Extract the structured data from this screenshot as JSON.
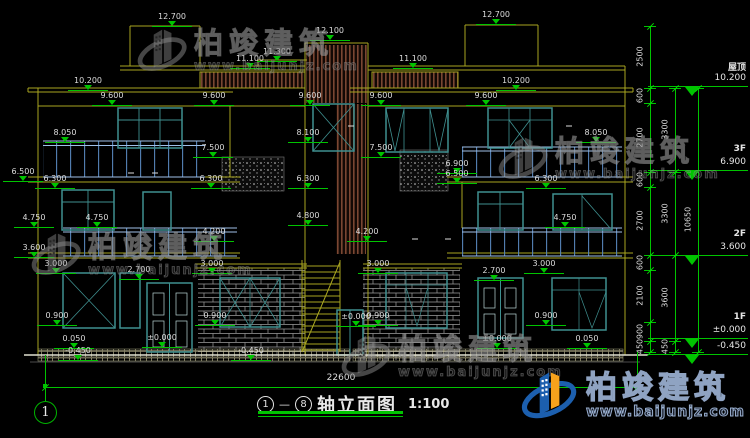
{
  "colors": {
    "yellow": "#a8a520",
    "teal": "#3f9090",
    "blue": "#5583b8",
    "green": "#00c400",
    "white": "#dcdcdc",
    "louver": "#7a4632",
    "wm_gray": "#8a8a8a",
    "logo_blue": "#1c5fae",
    "logo_orange": "#f6a21c"
  },
  "title_bar": {
    "axis_start": "1",
    "dash": "—",
    "axis_end": "8",
    "name": "轴立面图",
    "scale": "1:100",
    "axis_bubble": "1"
  },
  "watermark": {
    "brand": "柏竣建筑",
    "url": "www.baijunjz.com",
    "positions": [
      {
        "x": 136,
        "y": 22
      },
      {
        "x": 497,
        "y": 130
      },
      {
        "x": 30,
        "y": 226
      },
      {
        "x": 340,
        "y": 328
      }
    ]
  },
  "logo": {
    "brand": "柏竣建筑",
    "url": "www.baijunjz.com"
  },
  "dimensions": {
    "overall_width": {
      "value": "22600",
      "label_x": 317,
      "label_y": 373,
      "line_y": 387,
      "x1": 45,
      "x2": 637
    },
    "axis_line": {
      "x": 45,
      "y_top": 355,
      "y_bottom": 401
    },
    "elevation_markers": [
      {
        "v": "12.700",
        "x": 172,
        "y": 12
      },
      {
        "v": "12.700",
        "x": 496,
        "y": 10
      },
      {
        "v": "12.100",
        "x": 330,
        "y": 26
      },
      {
        "v": "11.300",
        "x": 277,
        "y": 47
      },
      {
        "v": "11.100",
        "x": 250,
        "y": 54
      },
      {
        "v": "11.100",
        "x": 413,
        "y": 54
      },
      {
        "v": "10.200",
        "x": 88,
        "y": 76
      },
      {
        "v": "10.200",
        "x": 516,
        "y": 76
      },
      {
        "v": "9.600",
        "x": 112,
        "y": 91
      },
      {
        "v": "9.600",
        "x": 214,
        "y": 91
      },
      {
        "v": "9.600",
        "x": 310,
        "y": 91
      },
      {
        "v": "9.600",
        "x": 381,
        "y": 91
      },
      {
        "v": "9.600",
        "x": 486,
        "y": 91
      },
      {
        "v": "8.050",
        "x": 65,
        "y": 128
      },
      {
        "v": "8.100",
        "x": 308,
        "y": 128
      },
      {
        "v": "8.050",
        "x": 596,
        "y": 128
      },
      {
        "v": "7.500",
        "x": 213,
        "y": 143
      },
      {
        "v": "7.500",
        "x": 381,
        "y": 143
      },
      {
        "v": "6.900",
        "x": 457,
        "y": 159
      },
      {
        "v": "6.500",
        "x": 23,
        "y": 167
      },
      {
        "v": "6.500",
        "x": 457,
        "y": 169
      },
      {
        "v": "6.300",
        "x": 55,
        "y": 174
      },
      {
        "v": "6.300",
        "x": 211,
        "y": 174
      },
      {
        "v": "6.300",
        "x": 308,
        "y": 174
      },
      {
        "v": "6.300",
        "x": 546,
        "y": 174
      },
      {
        "v": "4.750",
        "x": 34,
        "y": 213
      },
      {
        "v": "4.750",
        "x": 97,
        "y": 213
      },
      {
        "v": "4.800",
        "x": 308,
        "y": 211
      },
      {
        "v": "4.750",
        "x": 565,
        "y": 213
      },
      {
        "v": "4.200",
        "x": 214,
        "y": 227
      },
      {
        "v": "4.200",
        "x": 367,
        "y": 227
      },
      {
        "v": "3.600",
        "x": 34,
        "y": 243
      },
      {
        "v": "3.000",
        "x": 56,
        "y": 259
      },
      {
        "v": "3.000",
        "x": 212,
        "y": 259
      },
      {
        "v": "3.000",
        "x": 378,
        "y": 259
      },
      {
        "v": "3.000",
        "x": 544,
        "y": 259
      },
      {
        "v": "2.700",
        "x": 139,
        "y": 265
      },
      {
        "v": "2.700",
        "x": 494,
        "y": 266
      },
      {
        "v": "0.900",
        "x": 57,
        "y": 311
      },
      {
        "v": "0.900",
        "x": 215,
        "y": 311
      },
      {
        "v": "0.900",
        "x": 378,
        "y": 311
      },
      {
        "v": "0.900",
        "x": 546,
        "y": 311
      },
      {
        "v": "±0.000",
        "x": 356,
        "y": 312
      },
      {
        "v": "0.050",
        "x": 74,
        "y": 334
      },
      {
        "v": "±0.000",
        "x": 162,
        "y": 333
      },
      {
        "v": "±0.000",
        "x": 497,
        "y": 334
      },
      {
        "v": "0.050",
        "x": 587,
        "y": 334
      },
      {
        "v": "-0.450",
        "x": 78,
        "y": 346
      },
      {
        "v": "-0.450",
        "x": 251,
        "y": 346
      }
    ],
    "right_levels": [
      {
        "label": "屋顶",
        "value": "10.200",
        "line_y": 86
      },
      {
        "label": "3F",
        "value": "6.900",
        "line_y": 170
      },
      {
        "label": "2F",
        "value": "3.600",
        "line_y": 255
      },
      {
        "label": "1F",
        "value": "±0.000",
        "line_y": 338
      },
      {
        "label": "",
        "value": "-0.450",
        "line_y": 354
      }
    ],
    "chains": [
      {
        "x": 650,
        "segments": [
          {
            "len": "2500",
            "y1": 26,
            "y2": 88
          },
          {
            "len": "600",
            "y1": 88,
            "y2": 103
          },
          {
            "len": "2700",
            "y1": 103,
            "y2": 172
          },
          {
            "len": "600",
            "y1": 172,
            "y2": 187
          },
          {
            "len": "2700",
            "y1": 187,
            "y2": 255
          },
          {
            "len": "600",
            "y1": 255,
            "y2": 270
          },
          {
            "len": "2100",
            "y1": 270,
            "y2": 322
          },
          {
            "len": "900",
            "y1": 322,
            "y2": 341
          },
          {
            "len": "450",
            "y1": 341,
            "y2": 352
          }
        ]
      },
      {
        "x": 675,
        "segments": [
          {
            "len": "3300",
            "y1": 88,
            "y2": 172
          },
          {
            "len": "3300",
            "y1": 172,
            "y2": 255
          },
          {
            "len": "3600",
            "y1": 255,
            "y2": 341
          },
          {
            "len": "450",
            "y1": 341,
            "y2": 352
          }
        ]
      },
      {
        "x": 698,
        "segments": [
          {
            "len": "10650",
            "y1": 88,
            "y2": 352
          }
        ]
      }
    ]
  }
}
